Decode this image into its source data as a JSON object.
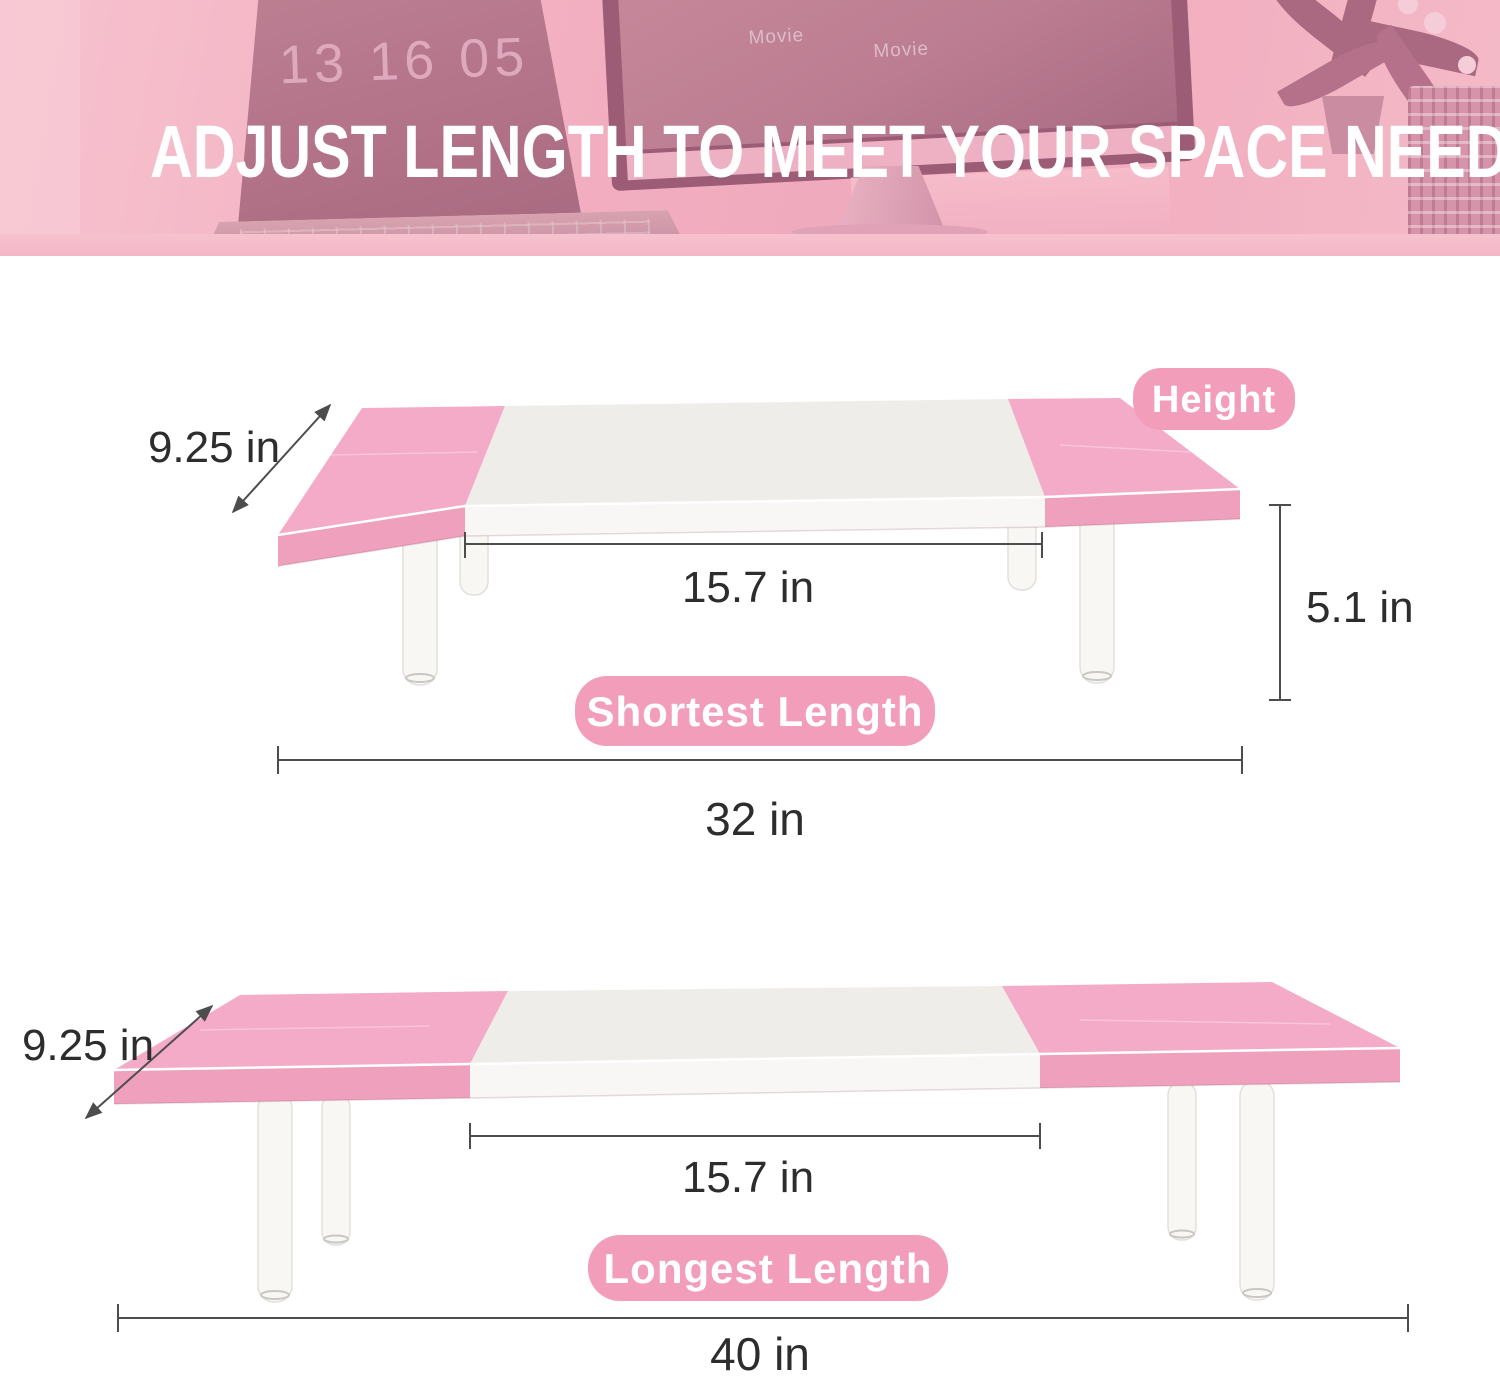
{
  "banner": {
    "headline": "ADJUST LENGTH TO MEET YOUR SPACE NEED",
    "laptop_clock": "13 16 05",
    "monitor_labels": [
      "Movie",
      "Movie",
      "Movie",
      "Movie"
    ]
  },
  "diagram_short": {
    "depth_label": "9.25 in",
    "height_badge_label": "Height",
    "platform_width_label": "15.7 in",
    "height_value_label": "5.1 in",
    "name_badge_label": "Shortest Length",
    "total_length_label": "32 in"
  },
  "diagram_long": {
    "depth_label": "9.25 in",
    "platform_width_label": "15.7 in",
    "name_badge_label": "Longest Length",
    "total_length_label": "40 in"
  },
  "colors": {
    "badge_pink": "#F29EBB",
    "table_pink_top": "#F4ABC8",
    "table_pink_face": "#EEA0BC",
    "board_white_top": "#EFEDE9",
    "board_white_face": "#F8F7F5",
    "leg_fill": "#F8F7F4",
    "dimension_line": "#4d4d4d",
    "dimension_text": "#2d2d2d",
    "banner_overlay_pink": "#f3b2c3",
    "headline_white": "#ffffff"
  }
}
